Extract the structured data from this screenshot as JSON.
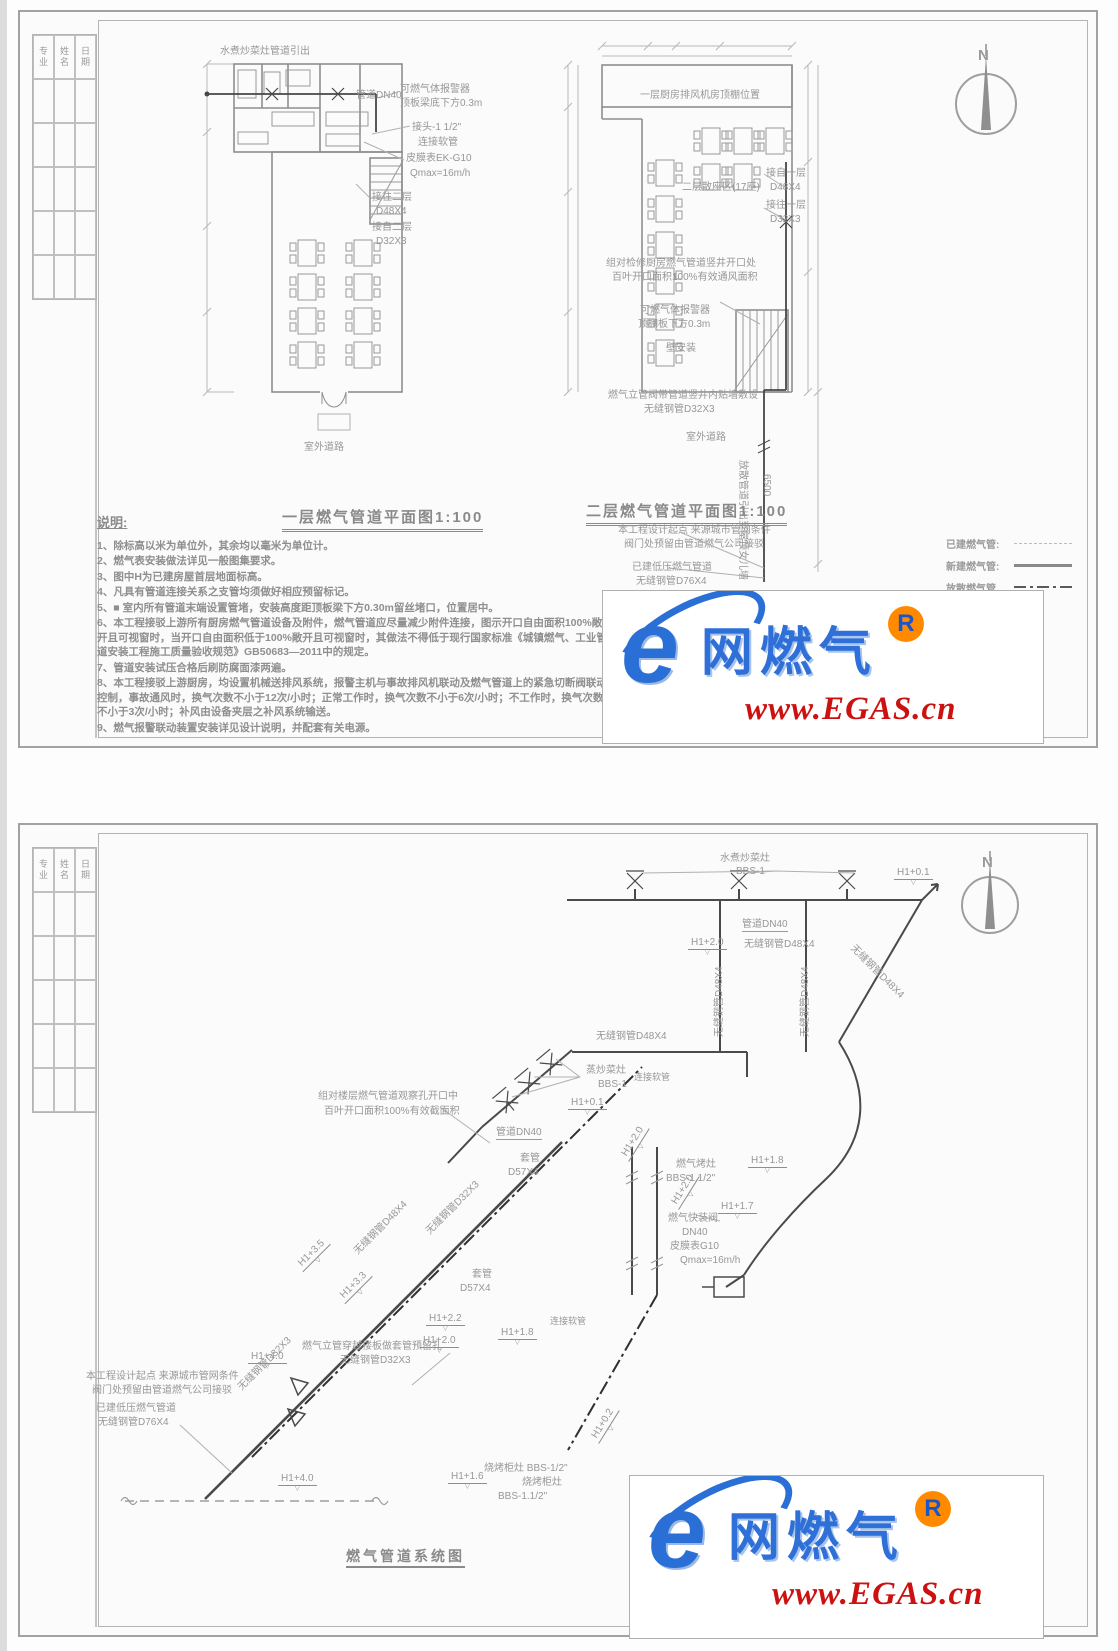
{
  "north_label": "N",
  "titleblock": {
    "cols": [
      "专业",
      "姓名",
      "日期"
    ]
  },
  "watermark": {
    "logo_letter": "e",
    "brand": "网燃气",
    "registered": "R",
    "url": "www.EGAS.cn"
  },
  "sheet1": {
    "notes": {
      "heading": "说明:",
      "items": [
        "1、除标高以米为单位外，其余均以毫米为单位计。",
        "2、燃气表安装做法详见一般图集要求。",
        "3、图中H为已建房屋首层地面标高。",
        "4、凡具有管道连接关系之支管均须做好相应预留标记。",
        "5、■  室内所有管道末端设置管堵，安装高度距顶板梁下方0.30m留丝堵口，位置居中。",
        "6、本工程接驳上游所有厨房燃气管道设备及附件，燃气管道应尽量减少附件连接，图示开口自由面积100%敞开且可视窗时，当开口自由面积低于100%敞开且可视窗时，其做法不得低于现行国家标准《城镇燃气、工业管道安装工程施工质量验收规范》GB50683—2011中的规定。",
        "7、管道安装试压合格后刷防腐面漆两遍。",
        "8、本工程接驳上游厨房，均设置机械送排风系统，报警主机与事故排风机联动及燃气管道上的紧急切断阀联动控制，事故通风时，换气次数不小于12次/小时；正常工作时，换气次数不小于6次/小时；不工作时，换气次数不小于3次/小时；补风由设备夹层之补风系统输送。",
        "9、燃气报警联动装置安装详见设计说明，并配套有关电源。"
      ]
    },
    "legend": {
      "rows": [
        {
          "label": "已建燃气管:",
          "style": "existing"
        },
        {
          "label": "新建燃气管:",
          "style": "new"
        },
        {
          "label": "放散燃气管",
          "style": "vent"
        }
      ]
    },
    "annotations": [
      {
        "text": "N",
        "x": 958,
        "y": 36,
        "cls": "north"
      },
      {
        "text": "水煮炒菜灶管道引出",
        "x": 200,
        "y": 34
      },
      {
        "text": "管道DN40",
        "x": 336,
        "y": 78
      },
      {
        "text": "可燃气体报警器",
        "x": 380,
        "y": 72
      },
      {
        "text": "顶板梁底下方0.3m",
        "x": 380,
        "y": 86
      },
      {
        "text": "接头-1 1/2\"",
        "x": 392,
        "y": 110
      },
      {
        "text": "连接软管",
        "x": 398,
        "y": 125
      },
      {
        "text": "皮膜表EK-G10",
        "x": 386,
        "y": 141
      },
      {
        "text": "Qmax=16m/h",
        "x": 390,
        "y": 156
      },
      {
        "text": "接往二层",
        "x": 352,
        "y": 180
      },
      {
        "text": "D48X4",
        "x": 356,
        "y": 194
      },
      {
        "text": "接自二层",
        "x": 352,
        "y": 210
      },
      {
        "text": "D32X3",
        "x": 356,
        "y": 224
      },
      {
        "text": "室外道路",
        "x": 284,
        "y": 430
      },
      {
        "text": "一层燃气管道平面图1:100",
        "x": 262,
        "y": 498,
        "cls": "title"
      },
      {
        "text": "一层厨房排风机房顶棚位置",
        "x": 620,
        "y": 78
      },
      {
        "text": "二层散座区(17座)",
        "x": 662,
        "y": 170
      },
      {
        "text": "接自一层",
        "x": 746,
        "y": 156
      },
      {
        "text": "D48X4",
        "x": 750,
        "y": 170
      },
      {
        "text": "接往一层",
        "x": 746,
        "y": 188
      },
      {
        "text": "D32X3",
        "x": 750,
        "y": 202
      },
      {
        "text": "组对检修厨房燃气管道竖井开口处",
        "x": 586,
        "y": 246
      },
      {
        "text": "百叶开口面积100%有效通风面积",
        "x": 592,
        "y": 260
      },
      {
        "text": "可燃气体报警器",
        "x": 620,
        "y": 293
      },
      {
        "text": "顶棚板下方0.3m",
        "x": 618,
        "y": 307
      },
      {
        "text": "壁安装",
        "x": 646,
        "y": 331
      },
      {
        "text": "燃气立管阀带管道竖井内贴墙敷设",
        "x": 588,
        "y": 378
      },
      {
        "text": "无缝钢管D32X3",
        "x": 624,
        "y": 392
      },
      {
        "text": "室外道路",
        "x": 666,
        "y": 420
      },
      {
        "text": "放散管道引出至屋顶女儿墙",
        "x": 728,
        "y": 448,
        "rot": 90
      },
      {
        "text": "6500",
        "x": 752,
        "y": 462,
        "rot": 90
      },
      {
        "text": "二层燃气管道平面图1:100",
        "x": 566,
        "y": 492,
        "cls": "title"
      },
      {
        "text": "本工程设计起点 来源城市管网条件",
        "x": 598,
        "y": 513
      },
      {
        "text": "阀门处预留由管道燃气公司接驳",
        "x": 604,
        "y": 527
      },
      {
        "text": "已建低压燃气管道",
        "x": 612,
        "y": 550
      },
      {
        "text": "无缝钢管D76X4",
        "x": 616,
        "y": 564
      }
    ]
  },
  "sheet2": {
    "annotations": [
      {
        "text": "N",
        "x": 962,
        "y": 30,
        "cls": "north"
      },
      {
        "text": "水煮炒菜灶",
        "x": 700,
        "y": 28
      },
      {
        "text": "BBS-1",
        "x": 716,
        "y": 41
      },
      {
        "text": "H1+0.1",
        "x": 874,
        "y": 42,
        "cls": "elev"
      },
      {
        "text": "H1+2.0",
        "x": 668,
        "y": 112,
        "cls": "elev"
      },
      {
        "text": "管道DN40",
        "x": 722,
        "y": 94,
        "cls": "und"
      },
      {
        "text": "无缝钢管D48X4",
        "x": 724,
        "y": 114
      },
      {
        "text": "无缝钢管D48X4",
        "x": 694,
        "y": 212,
        "rot": -90
      },
      {
        "text": "无缝钢管D48X4",
        "x": 780,
        "y": 212,
        "rot": -90
      },
      {
        "text": "无缝钢管D48X4",
        "x": 836,
        "y": 118,
        "rot": 45
      },
      {
        "text": "无缝钢管D48X4",
        "x": 576,
        "y": 206
      },
      {
        "text": "蒸炒菜灶",
        "x": 566,
        "y": 240
      },
      {
        "text": "BBS-1",
        "x": 578,
        "y": 254
      },
      {
        "text": "连接软管",
        "x": 614,
        "y": 248,
        "size": 9
      },
      {
        "text": "H1+0.1",
        "x": 548,
        "y": 272,
        "cls": "elev"
      },
      {
        "text": "管道DN40",
        "x": 476,
        "y": 302,
        "cls": "und"
      },
      {
        "text": "组对楼层燃气管道观察孔开口中",
        "x": 298,
        "y": 266
      },
      {
        "text": "百叶开口面积100%有效截面积",
        "x": 304,
        "y": 281
      },
      {
        "text": "H1+2.0",
        "x": 598,
        "y": 330,
        "rot": -58,
        "cls": "elevr"
      },
      {
        "text": "H1+2.0",
        "x": 648,
        "y": 378,
        "rot": -58,
        "cls": "elevr"
      },
      {
        "text": "燃气烤灶",
        "x": 656,
        "y": 334
      },
      {
        "text": "BBS-1.1/2\"",
        "x": 646,
        "y": 348
      },
      {
        "text": "H1+1.8",
        "x": 728,
        "y": 330,
        "cls": "elev"
      },
      {
        "text": "H1+1.7",
        "x": 698,
        "y": 376,
        "cls": "elev"
      },
      {
        "text": "燃气快装阀",
        "x": 648,
        "y": 388
      },
      {
        "text": "DN40",
        "x": 662,
        "y": 402
      },
      {
        "text": "皮膜表G10",
        "x": 650,
        "y": 416
      },
      {
        "text": "Qmax=16m/h",
        "x": 660,
        "y": 430
      },
      {
        "text": "套管",
        "x": 500,
        "y": 328
      },
      {
        "text": "D57X4",
        "x": 488,
        "y": 342
      },
      {
        "text": "套管",
        "x": 452,
        "y": 444
      },
      {
        "text": "D57X4",
        "x": 440,
        "y": 458
      },
      {
        "text": "H1+3.5",
        "x": 274,
        "y": 438,
        "rot": -45,
        "cls": "elevr"
      },
      {
        "text": "H1+3.3",
        "x": 316,
        "y": 470,
        "rot": -45,
        "cls": "elevr"
      },
      {
        "text": "无缝钢管D48X4",
        "x": 332,
        "y": 424,
        "rot": -45
      },
      {
        "text": "无缝钢管D32X3",
        "x": 404,
        "y": 404,
        "rot": -45
      },
      {
        "text": "无缝钢管D32X3",
        "x": 216,
        "y": 560,
        "rot": -45
      },
      {
        "text": "H1+2.2",
        "x": 406,
        "y": 488,
        "cls": "elev"
      },
      {
        "text": "H1+2.0",
        "x": 400,
        "y": 510,
        "cls": "elev"
      },
      {
        "text": "H1+1.8",
        "x": 478,
        "y": 502,
        "cls": "elev"
      },
      {
        "text": "连接软管",
        "x": 530,
        "y": 492,
        "size": 9
      },
      {
        "text": "燃气立管穿越楼板做套管预留孔",
        "x": 282,
        "y": 516
      },
      {
        "text": "无缝钢管D32X3",
        "x": 320,
        "y": 530
      },
      {
        "text": "本工程设计起点 来源城市管网条件",
        "x": 66,
        "y": 546
      },
      {
        "text": "阀门处预留由管道燃气公司接驳",
        "x": 72,
        "y": 560
      },
      {
        "text": "已建低压燃气管道",
        "x": 76,
        "y": 578
      },
      {
        "text": "无缝钢管D76X4",
        "x": 78,
        "y": 592
      },
      {
        "text": "H1+4.0",
        "x": 228,
        "y": 526,
        "cls": "elev"
      },
      {
        "text": "H1+4.0",
        "x": 258,
        "y": 648,
        "cls": "elev"
      },
      {
        "text": "H1+0.2",
        "x": 568,
        "y": 612,
        "rot": -58,
        "cls": "elevr"
      },
      {
        "text": "H1+1.6",
        "x": 428,
        "y": 646,
        "cls": "elev"
      },
      {
        "text": "烧烤柜灶 BBS-1/2\"",
        "x": 464,
        "y": 638
      },
      {
        "text": "烧烤柜灶",
        "x": 502,
        "y": 652
      },
      {
        "text": "BBS-1.1/2\"",
        "x": 478,
        "y": 666
      },
      {
        "text": "燃气管道系统图",
        "x": 326,
        "y": 724,
        "cls": "title2"
      }
    ]
  }
}
